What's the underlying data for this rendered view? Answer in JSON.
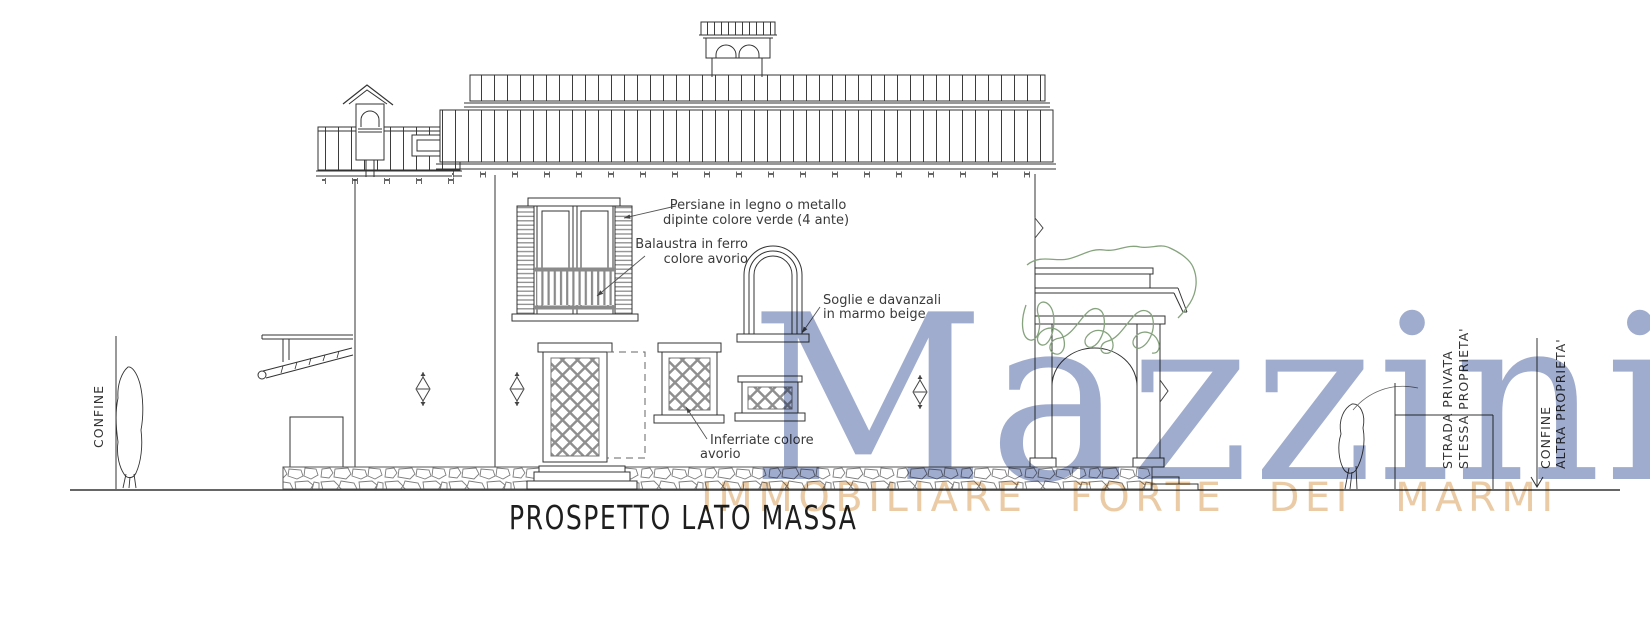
{
  "title": {
    "label": "PROSPETTO LATO MASSA"
  },
  "annotations": {
    "persiane": {
      "line1": "Persiane in legno o metallo",
      "line2": "dipinte colore verde (4 ante)"
    },
    "balaustra": {
      "line1": "Balaustra in ferro",
      "line2": "colore avorio"
    },
    "soglie": {
      "line1": "Soglie e davanzali",
      "line2": "in marmo beige"
    },
    "inferriate": {
      "line1": "Inferriate colore",
      "line2": "avorio"
    }
  },
  "site_labels": {
    "left_boundary": "CONFINE",
    "private_road_line1": "STRADA PRIVATA",
    "private_road_line2": "STESSA PROPRIETA'",
    "right_boundary_line1": "CONFINE",
    "right_boundary_line2": "ALTRA PROPRIETA'"
  },
  "watermark": {
    "brand": "Mazzini",
    "tagline": "IMMOBILIARE FORTE DEI MARMI",
    "brand_color": "#8F9DC4",
    "tagline_color": "#E8C59B"
  },
  "colors": {
    "line": "#333333",
    "detail_gray": "#8A8A8A",
    "vegetation_green": "#86A37E",
    "background": "#FFFFFF"
  }
}
